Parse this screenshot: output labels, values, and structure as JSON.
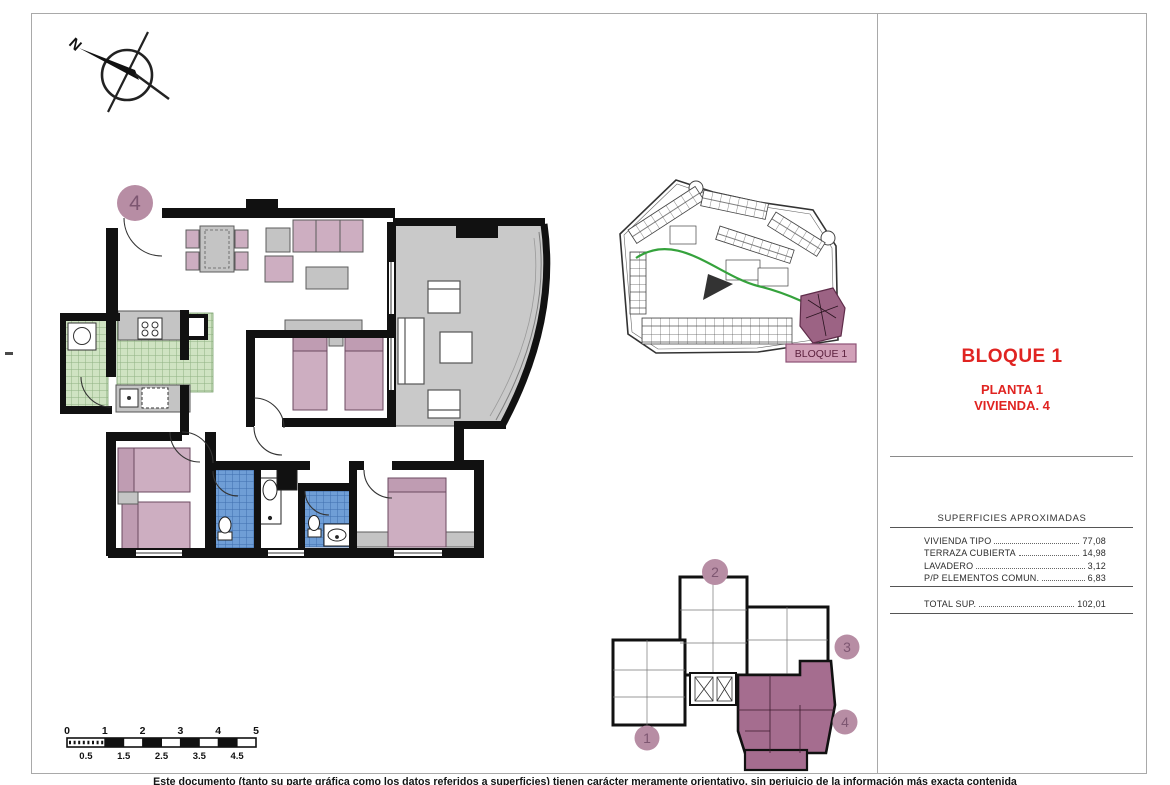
{
  "compass": {
    "north_label": "N"
  },
  "floor_plan": {
    "unit_badge": "4"
  },
  "site_plan": {
    "block_label": "BLOQUE 1"
  },
  "key_plan": {
    "units": [
      "1",
      "2",
      "3",
      "4"
    ],
    "highlighted_unit": "4"
  },
  "info_panel": {
    "title": "BLOQUE 1",
    "subtitle_line1": "PLANTA 1",
    "subtitle_line2": "VIVIENDA. 4",
    "table": {
      "header": "SUPERFICIES APROXIMADAS",
      "rows": [
        {
          "label": "VIVIENDA TIPO",
          "value": "77,08"
        },
        {
          "label": "TERRAZA CUBIERTA",
          "value": "14,98"
        },
        {
          "label": "LAVADERO",
          "value": "3,12"
        },
        {
          "label": "P/P ELEMENTOS COMUN.",
          "value": "6,83"
        }
      ],
      "total": {
        "label": "TOTAL SUP.",
        "value": "102,01"
      }
    }
  },
  "scale_bar": {
    "top_labels": [
      "0",
      "1",
      "2",
      "3",
      "4",
      "5"
    ],
    "bottom_labels": [
      "0.5",
      "1.5",
      "2.5",
      "3.5",
      "4.5"
    ]
  },
  "footer": {
    "disclaimer": "Este documento (tanto su parte gráfica como los datos referidos a superficies) tienen carácter meramente orientativo, sin perjuicio de la información más exacta contenida"
  },
  "colors": {
    "accent_red": "#e02421",
    "badge_mauve": "#b78da4",
    "badge_number": "#7d5671",
    "highlight_purple": "#a56d8f",
    "site_block_purple": "#9c6384",
    "label_box_pink": "#d1a0b8",
    "bed_pink": "#cdaec1",
    "kitchen_green": "#cfe3c2",
    "bath_blue": "#6f9ed6",
    "terrace_gray": "#c9c9c9",
    "path_green": "#35a23c"
  }
}
